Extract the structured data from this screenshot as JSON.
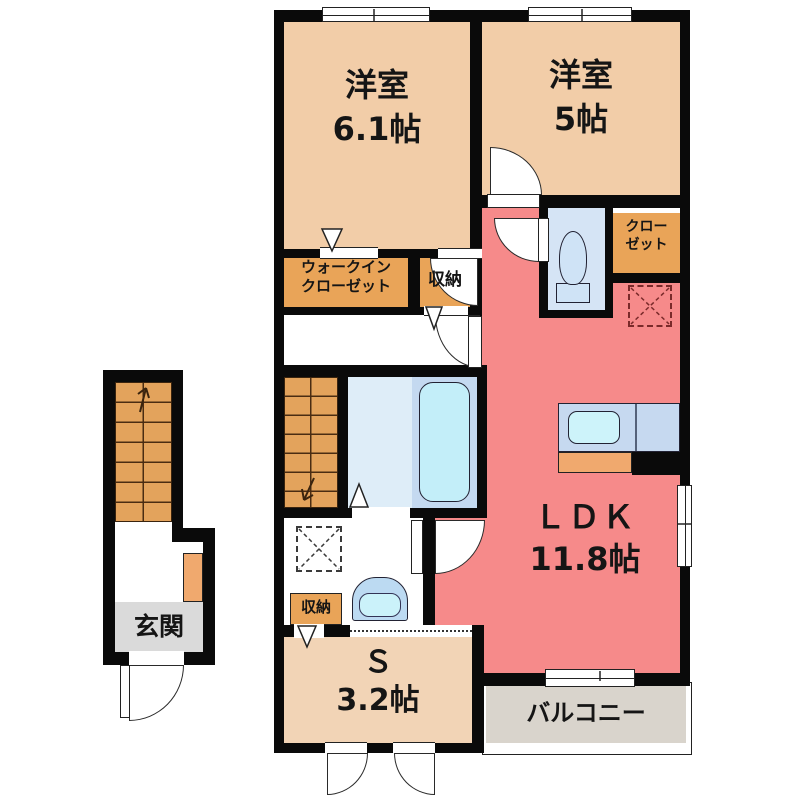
{
  "title": "floor-plan",
  "colors": {
    "wall": "#0a0a0a",
    "room_peach": "#F2CDA8",
    "service_peach": "#F2D4B6",
    "ldk_salmon": "#F68A8A",
    "closet_orange": "#E9A458",
    "stairs_orange": "#E3A35C",
    "balcony_gray": "#D9D4CC",
    "entrance_gray": "#DADADA",
    "water_blue": "#C4D9F0",
    "tub_blue": "#C3EEF9"
  },
  "rooms": {
    "western1": {
      "name": "洋室",
      "size": "6.1帖"
    },
    "western2": {
      "name": "洋室",
      "size": "5帖"
    },
    "ldk": {
      "name": "ＬＤＫ",
      "size": "11.8帖"
    },
    "service": {
      "name": "Ｓ",
      "size": "3.2帖"
    },
    "balcony": {
      "label": "バルコニー"
    },
    "entrance": {
      "label": "玄関"
    },
    "walk_in_closet": {
      "line1": "ウォークイン",
      "line2": "クローゼット"
    },
    "closet": {
      "line1": "クロー",
      "line2": "ゼット"
    },
    "storage_top": {
      "label": "収納"
    },
    "storage_bottom": {
      "label": "収納"
    }
  },
  "fixtures": {
    "toilet": "toilet",
    "bathtub": "bathtub",
    "kitchen_sink": "kitchen-sink",
    "washbasin": "washbasin",
    "washer_space": "washing-machine-space",
    "fridge_space": "refrigerator-space"
  }
}
